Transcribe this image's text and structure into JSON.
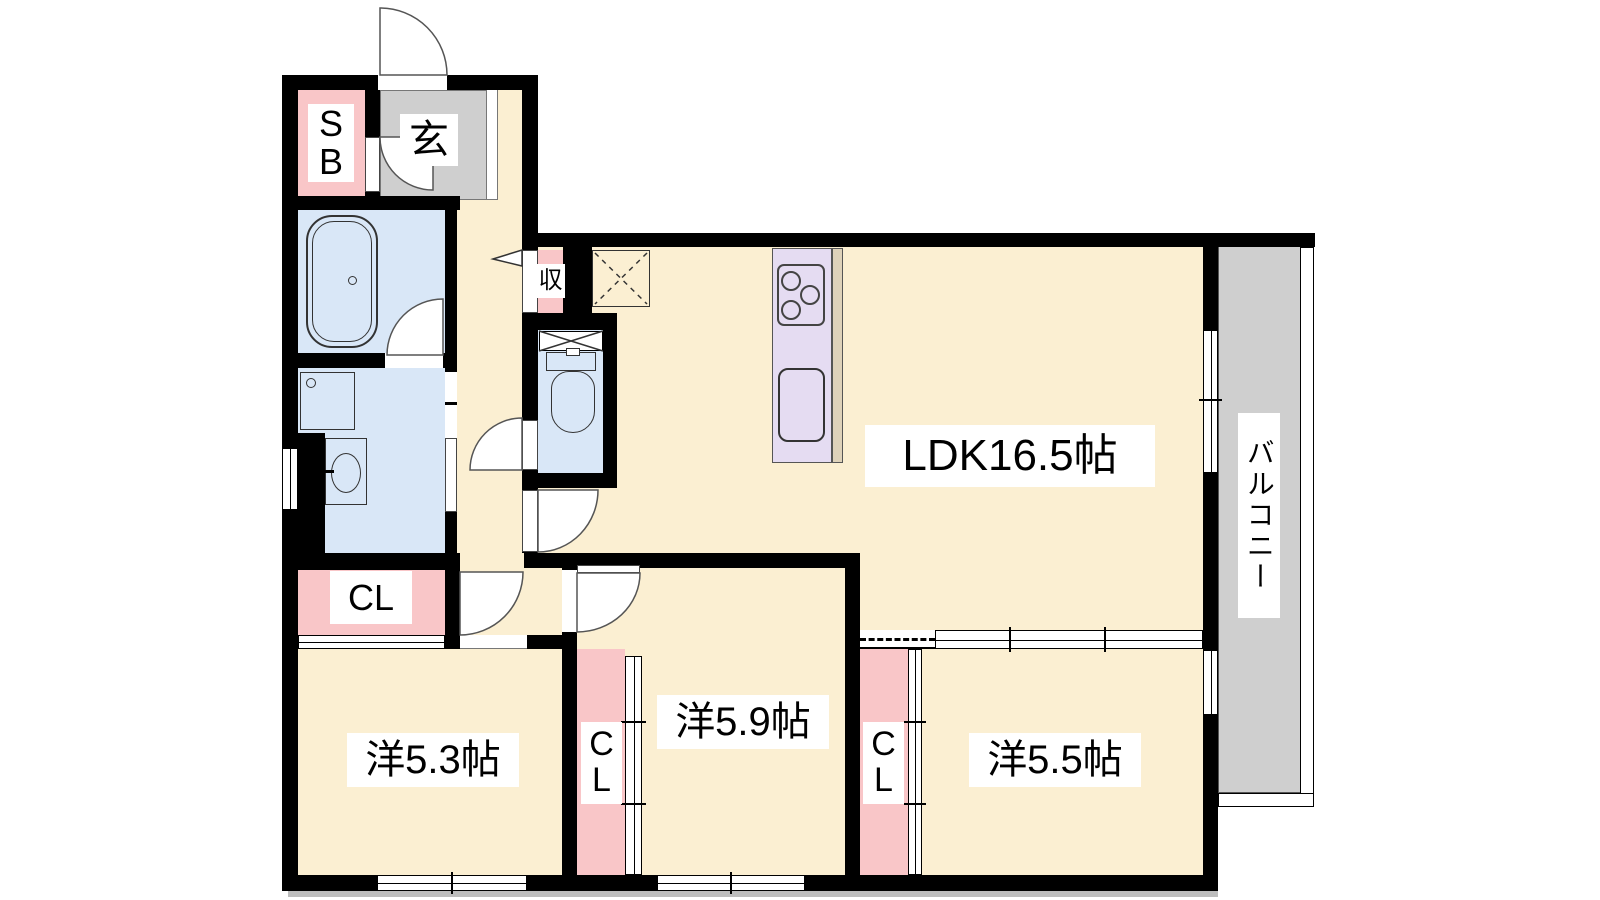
{
  "plan_title": "apartment-floor-plan",
  "rooms": {
    "ldk": {
      "label": "LDK16.5帖"
    },
    "west53": {
      "label": "洋5.3帖"
    },
    "west59": {
      "label": "洋5.9帖"
    },
    "west55": {
      "label": "洋5.5帖"
    },
    "balcony": {
      "label": "バルコニー"
    },
    "genkan": {
      "label": "玄"
    },
    "shoebox": {
      "label": "SB"
    },
    "storage": {
      "label": "収"
    },
    "closet53": {
      "label": "CL"
    },
    "closet59": {
      "label": "CL"
    },
    "closet55": {
      "label": "CL"
    }
  },
  "colors": {
    "cream": "#FBEFD2",
    "pink": "#F9C6C8",
    "blue": "#D9E7F7",
    "gray": "#CFCFCF",
    "lavender": "#E5DCF2",
    "tan": "#DED2BA",
    "wall": "#000000",
    "label_bg": "#FFFFFF"
  }
}
